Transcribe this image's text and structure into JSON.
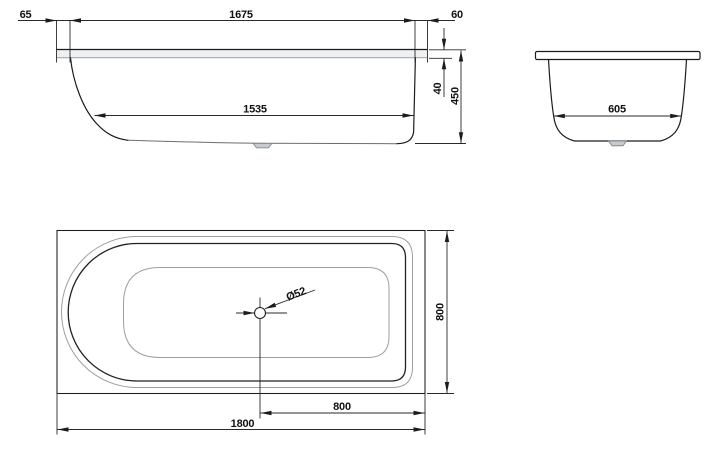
{
  "drawing": {
    "title": "bathtub-dimension-drawing",
    "background": "#ffffff",
    "line_color": "#1c1c1c",
    "secondary_line_color": "#9aa0a3",
    "views": {
      "side_view": {
        "name": "side elevation",
        "dims": {
          "left_rim_overhang": "65",
          "rim_inner_length": "1675",
          "right_rim_overhang": "60",
          "bottom_inner_length": "1535",
          "rim_edge_height": "40",
          "overall_height": "450"
        }
      },
      "end_view": {
        "name": "end elevation",
        "dims": {
          "bottom_inner_width": "605"
        }
      },
      "top_view": {
        "name": "plan view",
        "dims": {
          "drain_diameter": "Ø52",
          "overall_width": "800",
          "drain_offset_from_right": "800",
          "overall_length": "1800"
        }
      }
    }
  }
}
